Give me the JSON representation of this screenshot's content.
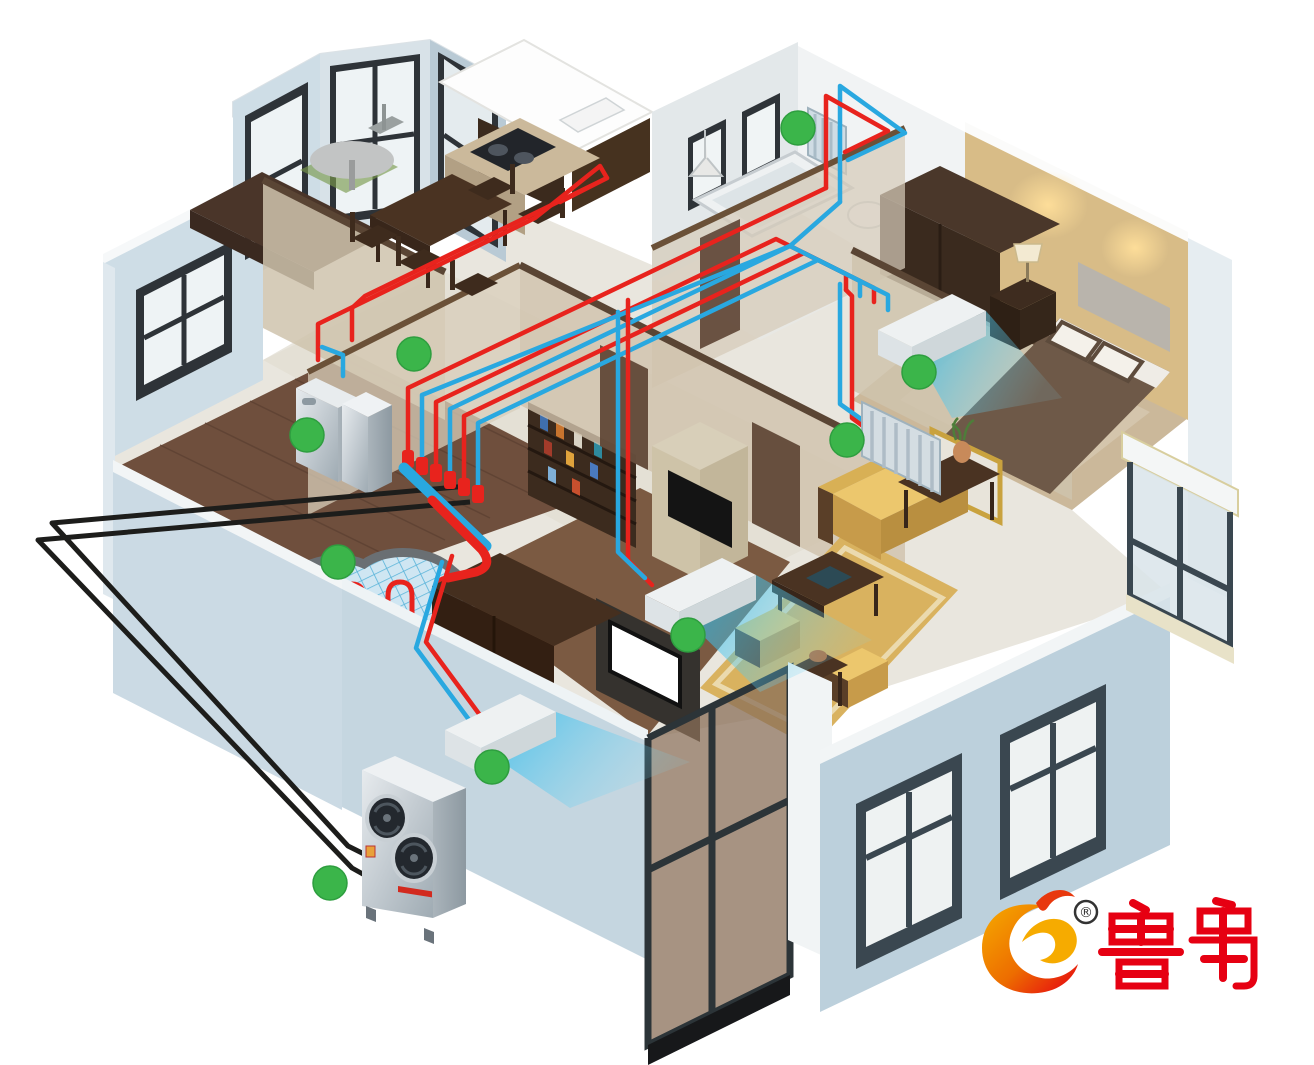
{
  "page": {
    "background": "#ffffff",
    "description": "Isometric cutaway illustration of an apartment showing an air-source heat pump system: outdoor unit, indoor hydronic unit, manifold, hot (red) and cold (blue) piping, fan coils, radiators and underfloor heating"
  },
  "logo": {
    "brand_text": "鲁禹",
    "registered_mark": "®",
    "brand_color": "#e60012",
    "flame_color_outer": "#e8380d",
    "flame_color_inner": "#f6ab00"
  },
  "colors": {
    "hot_pipe": "#e8231d",
    "cold_pipe": "#29a8e0",
    "ground_pipe": "#1d1d1b",
    "marker_green": "#3bb54a",
    "exterior_wall": "#c6d6e1",
    "interior_wall": "#cfc2ab",
    "wood_floor": "#6f4f3d",
    "tile_floor": "#e9e6de",
    "rug": "#d9b25f",
    "sofa": "#ecc76d",
    "airflow": "#29b8e8"
  },
  "diagram": {
    "type": "isometric-home-hvac-cutaway",
    "marker_radius": 17,
    "markers": [
      {
        "x": 798,
        "y": 128
      },
      {
        "x": 414,
        "y": 354
      },
      {
        "x": 307,
        "y": 435
      },
      {
        "x": 919,
        "y": 372
      },
      {
        "x": 847,
        "y": 440
      },
      {
        "x": 688,
        "y": 635
      },
      {
        "x": 492,
        "y": 767
      },
      {
        "x": 338,
        "y": 562
      },
      {
        "x": 330,
        "y": 883
      }
    ],
    "equipment": [
      {
        "name": "outdoor-heat-pump-unit"
      },
      {
        "name": "indoor-hydronic-unit"
      },
      {
        "name": "pipe-manifold"
      },
      {
        "name": "underfloor-heating-coil"
      },
      {
        "name": "bathroom-radiator"
      },
      {
        "name": "bedroom-radiator"
      },
      {
        "name": "bedroom-fan-coil"
      },
      {
        "name": "living-room-fan-coil"
      },
      {
        "name": "study-fan-coil"
      }
    ]
  }
}
